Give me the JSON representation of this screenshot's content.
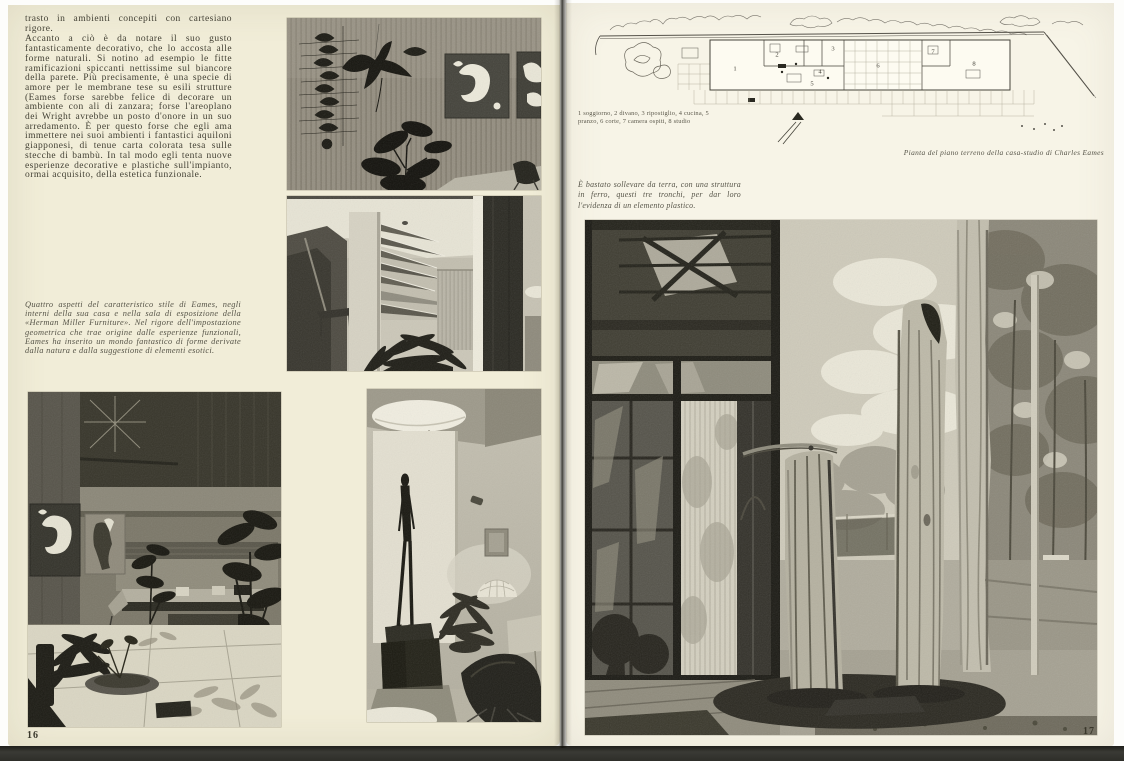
{
  "left_page": {
    "page_number": "16",
    "paragraphs": [
      "trasto in ambienti concepiti con cartesiano rigore.",
      "Accanto a ciò è da notare il suo gusto fantasticamente decorativo, che lo accosta alle forme naturali. Si notino ad esempio le fitte ramificazioni spiccanti nettissime sul biancore della parete. Più precisamente, è una specie di amore per le membrane tese su esili strutture (Eames forse sarebbe felice di decorare un ambiente con ali di zanzara; forse l'areoplano dei Wright avrebbe un posto d'onore in un suo arredamento. È per questo forse che egli ama immettere nei suoi ambienti i fantastici aquiloni giapponesi, di tenue carta colorata tesa sulle stecche di bambù. In tal modo egli tenta nuove esperienze decorative e plastiche sull'impianto, ormai acquisito, della estetica funzionale."
    ],
    "caption": "Quattro aspetti del caratteristico stile di Eames, negli interni della sua casa e nella sala di esposizione della «Herman Miller Furniture». Nel rigore dell'impostazione geometrica che trae origine dalle esperienze funzionali, Eames ha inserito un mondo fantastico di forme derivate dalla natura e dalla suggestione di elementi esotici."
  },
  "right_page": {
    "page_number": "17",
    "plan": {
      "legend": "1 soggiorno, 2 divano, 3 ripostiglio, 4 cucina, 5 pranzo, 6 corte, 7 camera ospiti, 8 studio",
      "caption": "Pianta del piano terreno della casa-studio di Charles Eames",
      "rooms": [
        {
          "n": "1"
        },
        {
          "n": "2"
        },
        {
          "n": "3"
        },
        {
          "n": "4"
        },
        {
          "n": "5"
        },
        {
          "n": "6"
        },
        {
          "n": "7"
        },
        {
          "n": "8"
        }
      ]
    },
    "photo_caption": "È bastato sollevare da terra, con una struttura in ferro, questi tre tronchi, per dar loro l'evidenza di un elemento plastico."
  },
  "colors": {
    "paper_left": "#f1edd8",
    "paper_right": "#f7f4e7",
    "ink": "#413f33"
  }
}
